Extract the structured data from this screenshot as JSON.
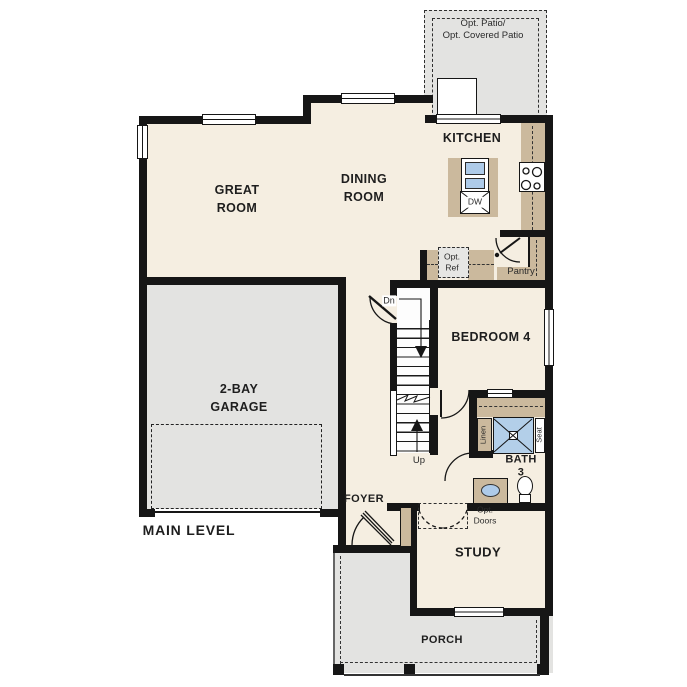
{
  "plan": {
    "level_title": "MAIN LEVEL",
    "colors": {
      "wall": "#161616",
      "room_fill": "#f5eee1",
      "exterior_fill": "#e3e3e1",
      "counter_tan": "#cbb99d",
      "fixture_blue": "#aecbe9"
    },
    "labels": {
      "opt_patio": "Opt. Patio/\nOpt. Covered Patio",
      "kitchen": "KITCHEN",
      "great_room": "GREAT\nROOM",
      "dining_room": "DINING\nROOM",
      "dw": "DW",
      "opt_ref": "Opt.\nRef",
      "pantry": "Pantry",
      "dn": "Dn",
      "up": "Up",
      "bedroom4": "BEDROOM 4",
      "linen": "Linen",
      "seat": "Seat",
      "bath3": "BATH\n3",
      "garage": "2-BAY\nGARAGE",
      "main_level": "MAIN LEVEL",
      "foyer": "FOYER",
      "opt_doors": "Opt.\nDoors",
      "study": "STUDY",
      "porch": "PORCH"
    }
  }
}
